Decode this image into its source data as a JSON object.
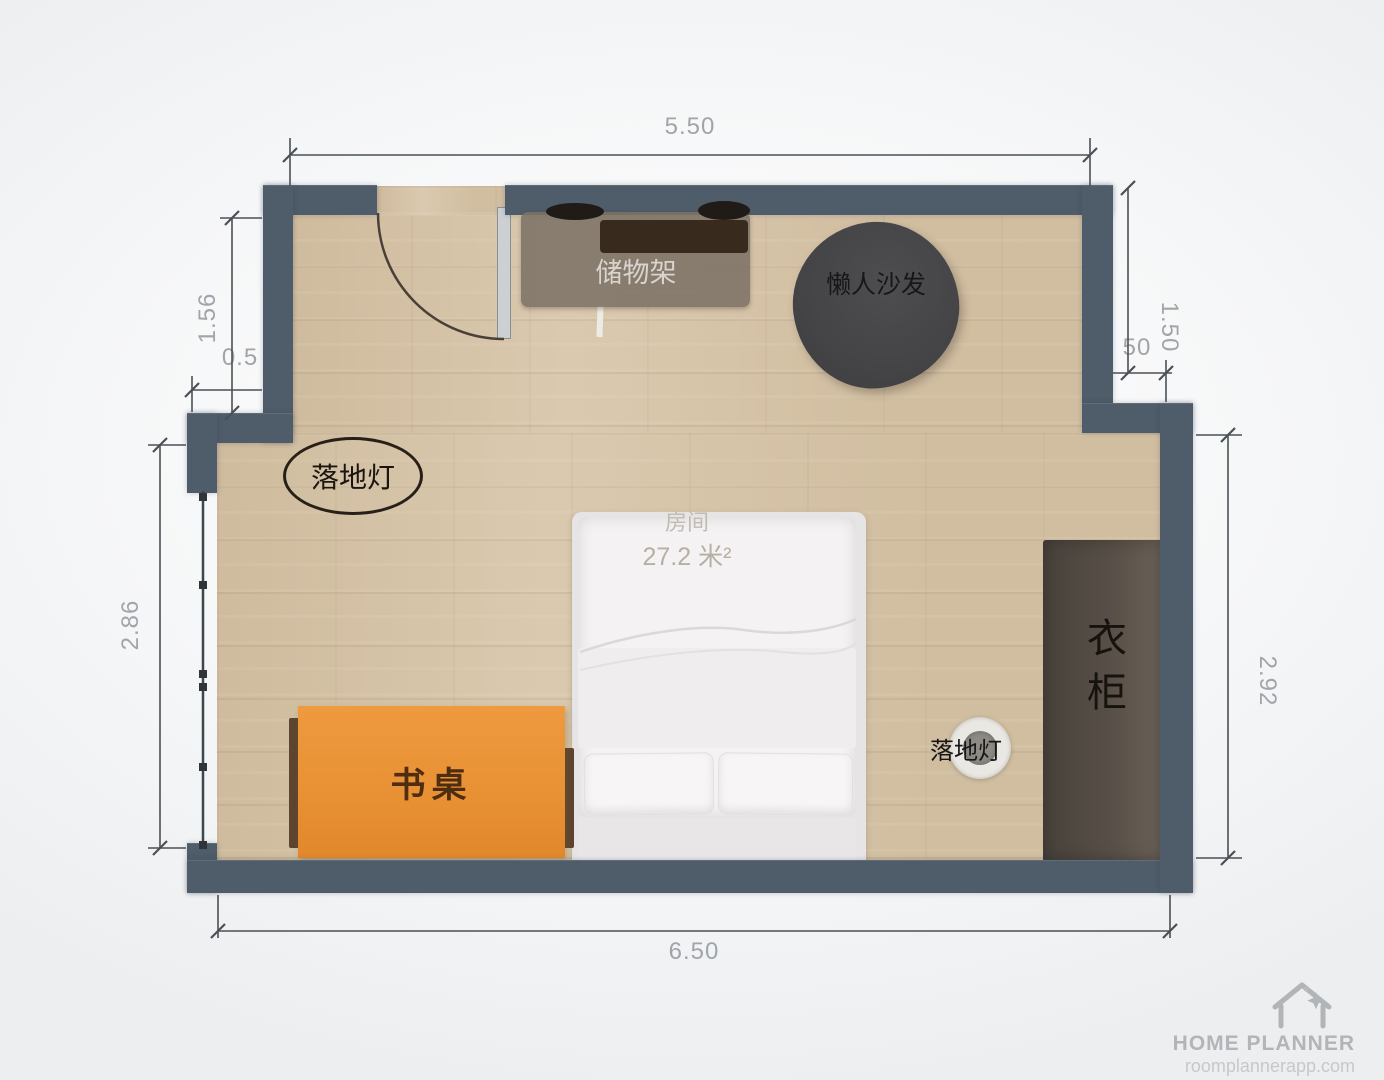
{
  "room": {
    "name": "房间",
    "area_label": "27.2 米²"
  },
  "dimensions": {
    "top": "5.50",
    "bottom": "6.50",
    "left_upper": "1.56",
    "left_step": "0.5",
    "left_lower": "2.86",
    "right_upper": "1.50",
    "right_step": "50",
    "right_lower": "2.92"
  },
  "furniture": {
    "storage_shelf": {
      "label": "储物架"
    },
    "bean_bag": {
      "label": "懒人沙发"
    },
    "floor_lamp_left": {
      "label": "落地灯"
    },
    "floor_lamp_right": {
      "label": "落地灯"
    },
    "desk": {
      "label": "书桌"
    },
    "wardrobe": {
      "label": "衣柜"
    }
  },
  "watermark": {
    "brand": "HOME PLANNER",
    "url": "roomplannerapp.com",
    "icon": "house-icon"
  },
  "colors": {
    "wall": "#4f5c69",
    "floor": "#d8c6aa",
    "desk": "#e89034",
    "wardrobe": "#574f47",
    "bean_bag": "#454548",
    "bed": "#f4f2f3",
    "dimension_text": "#a0a5aa",
    "background": "#f6f7f8"
  }
}
